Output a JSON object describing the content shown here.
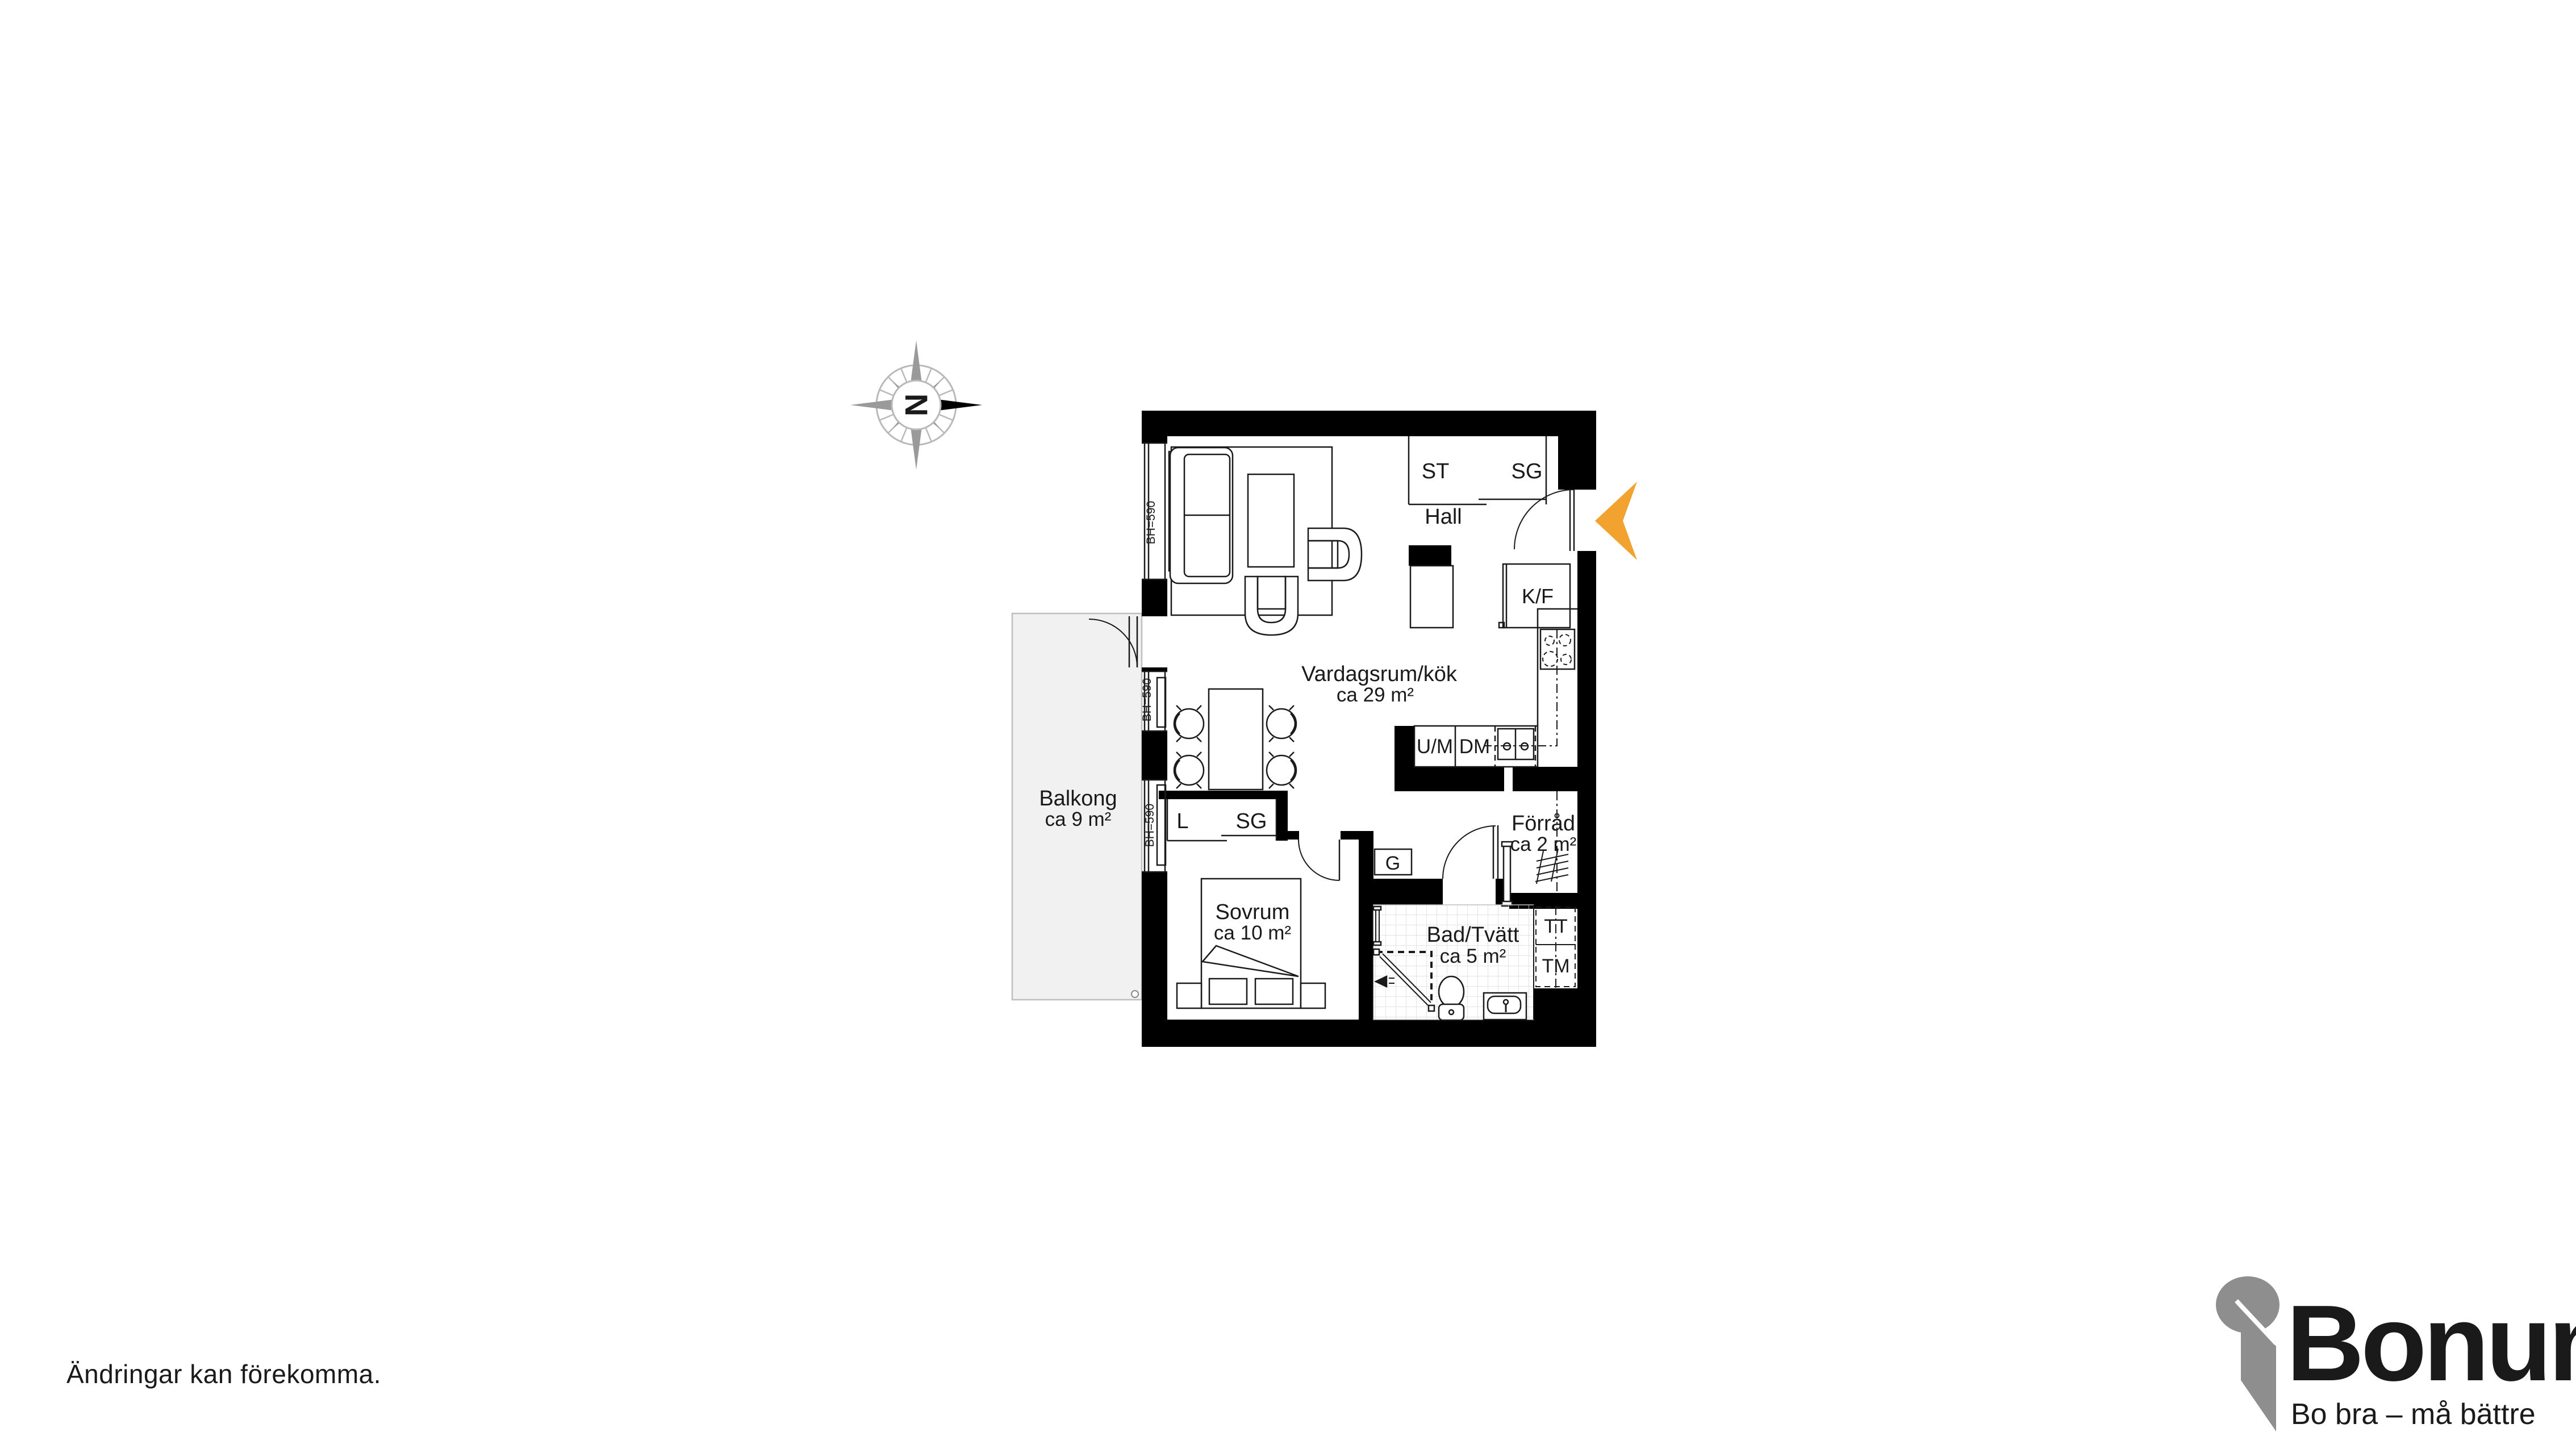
{
  "disclaimer": {
    "text": "Ändringar kan förekomma."
  },
  "compass": {
    "letter": "N"
  },
  "entrance": {
    "marker_color": "#F2A22E"
  },
  "floorplan": {
    "rooms": {
      "living": {
        "name": "Vardagsrum/kök",
        "area": "ca 29 m²"
      },
      "bedroom": {
        "name": "Sovrum",
        "area": "ca 10 m²"
      },
      "bath": {
        "name": "Bad/Tvätt",
        "area": "ca 5 m²"
      },
      "hall": {
        "name": "Hall"
      },
      "storage": {
        "name": "Förråd",
        "area": "ca 2 m²"
      },
      "balcony": {
        "name": "Balkong",
        "area": "ca 9 m²"
      }
    },
    "fixtures": {
      "st": "ST",
      "sg_hall": "SG",
      "kf": "K/F",
      "um": "U/M",
      "dm": "DM",
      "g": "G",
      "l": "L",
      "sg_bedroom": "SG",
      "tt": "TT",
      "tm": "TM"
    },
    "window_label": "BH=590"
  },
  "logo": {
    "name": "Bonum",
    "tagline": "Bo bra – må bättre",
    "orange": "#F0A22C",
    "gray": "#8E8E8E"
  }
}
